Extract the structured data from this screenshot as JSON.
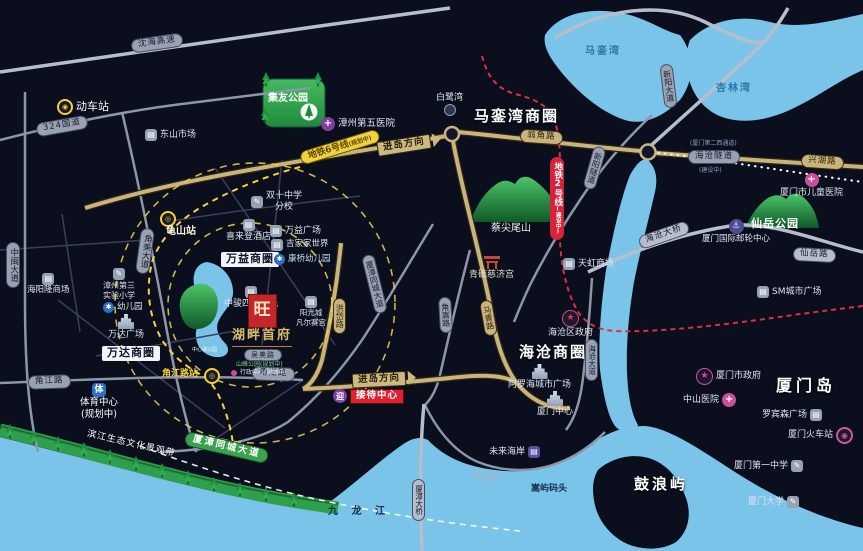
{
  "logo": {
    "seal": "旺",
    "name": "湖畔首府"
  },
  "bays": {
    "maluan": "马銮湾",
    "xinglin": "杏林湾"
  },
  "water": {
    "jiulong": "九 龙 江",
    "gulangyu": "鼓浪屿",
    "xiamen_island": "厦门岛"
  },
  "circles": {
    "maluanwan": "马銮湾商圈",
    "wanyi": "万益商圈",
    "wanda": "万达商圈",
    "haicang": "海沧商圈"
  },
  "metro": {
    "line6": "地铁6号线",
    "line6_status": "(规划中)",
    "line2": "地铁2号线",
    "line2_status": "(建设中)",
    "guishan_station": "龟山站",
    "jiaojiang_station": "角江路站"
  },
  "direction": {
    "jindao_top": "进岛方向",
    "jindao_bottom": "进岛方向",
    "reception": "接待中心"
  },
  "roads": {
    "shenhai": "沈海高速",
    "g324": "324国道",
    "zhongmin": "中闽大道",
    "jiaomei": "角美大道",
    "jiaojiang_w": "角江路",
    "jiaojiang_e": "角江路",
    "wengjiao": "翁角路",
    "xinyang_ave": "新阳大道",
    "xinyang_tunnel": "新阳隧道",
    "xinghu": "兴湖路",
    "haicang_tunnel": "海沧隧道",
    "haicang_tunnel_alias": "(厦门第二西通道)",
    "haicang_tunnel_status": "(建设中)",
    "haicang_bridge": "海沧大桥",
    "xianyue": "仙岳路",
    "maqing": "马青路",
    "jiaosong": "角嵩路",
    "hongdai": "洪岱路",
    "tongcheng": "厦漳同城大道",
    "tongcheng_badge": "厦漳同城大道",
    "haicang_ave": "海沧大道",
    "jiangang": "建港路",
    "xiazhang_bridge": "厦漳大桥",
    "wumei": "吴美路",
    "binjiang_belt": "滨江生态文化景观带"
  },
  "parks": {
    "jiyou": "集友公园",
    "xianyue": "仙岳公园",
    "caijianwei": "蔡尖尾山",
    "lake": "中心湖公园"
  },
  "pois": {
    "dongche": "动车站",
    "dongshan": "东山市场",
    "zhangzhou5": "漳州第五医院",
    "bailuwan": "白鹭湾",
    "sheraton": "喜来登酒店",
    "shuangshi_l1": "双十中学",
    "shuangshi_l2": "分校",
    "wanyi_plaza": "万益广场",
    "jijia": "吉家家世界",
    "kangqiao": "康桥幼儿园",
    "zhongjun": "中骏四季阳光",
    "yangguang_l1": "阳光城",
    "yangguang_l2": "凡尔赛宫",
    "haiyanglong": "海阳隆商场",
    "zhangzhou3_l1": "漳州第三",
    "zhangzhou3_l2": "实验小学",
    "youeryuan": "幼儿园",
    "wanda_plaza": "万达广场",
    "sports_l1": "体育中心",
    "sports_l2": "(规划中)",
    "shanfeng": "山峰公园(规划中)",
    "xingzheng": "行政中心(规划中)",
    "tianhong": "天虹商场",
    "qingjiao": "青礁慈济宫",
    "haicang_gov": "海沧区政府",
    "aluohai": "阿罗海城市广场",
    "xiamen_center": "厦门中心",
    "weilai": "未来海岸",
    "children_hospital": "厦门市儿童医院",
    "cruise": "厦门国际邮轮中心",
    "sm": "SM城市广场",
    "xiamen_gov": "厦门市政府",
    "zhongshan_hospital": "中山医院",
    "robinson": "罗宾森广场",
    "xiamen_train": "厦门火车站",
    "no1_school": "厦门第一中学",
    "xiamen_univ": "厦门大学",
    "songyu": "嵩屿码头"
  },
  "icons": {
    "star": "★",
    "cross": "+",
    "anchor": "⚓",
    "building": "▤",
    "school": "✎",
    "kinder": "✱",
    "metro": "◎",
    "station": "◉",
    "sports_char": "体",
    "reception_char": "迎"
  },
  "colors": {
    "water": "#7ac4e9",
    "road_tan": "#c9b47e",
    "metro6_yellow": "#f2d13e",
    "metro2_red": "#d6233a",
    "park_green": "#2fa34c",
    "seal_red": "#c3272b"
  }
}
